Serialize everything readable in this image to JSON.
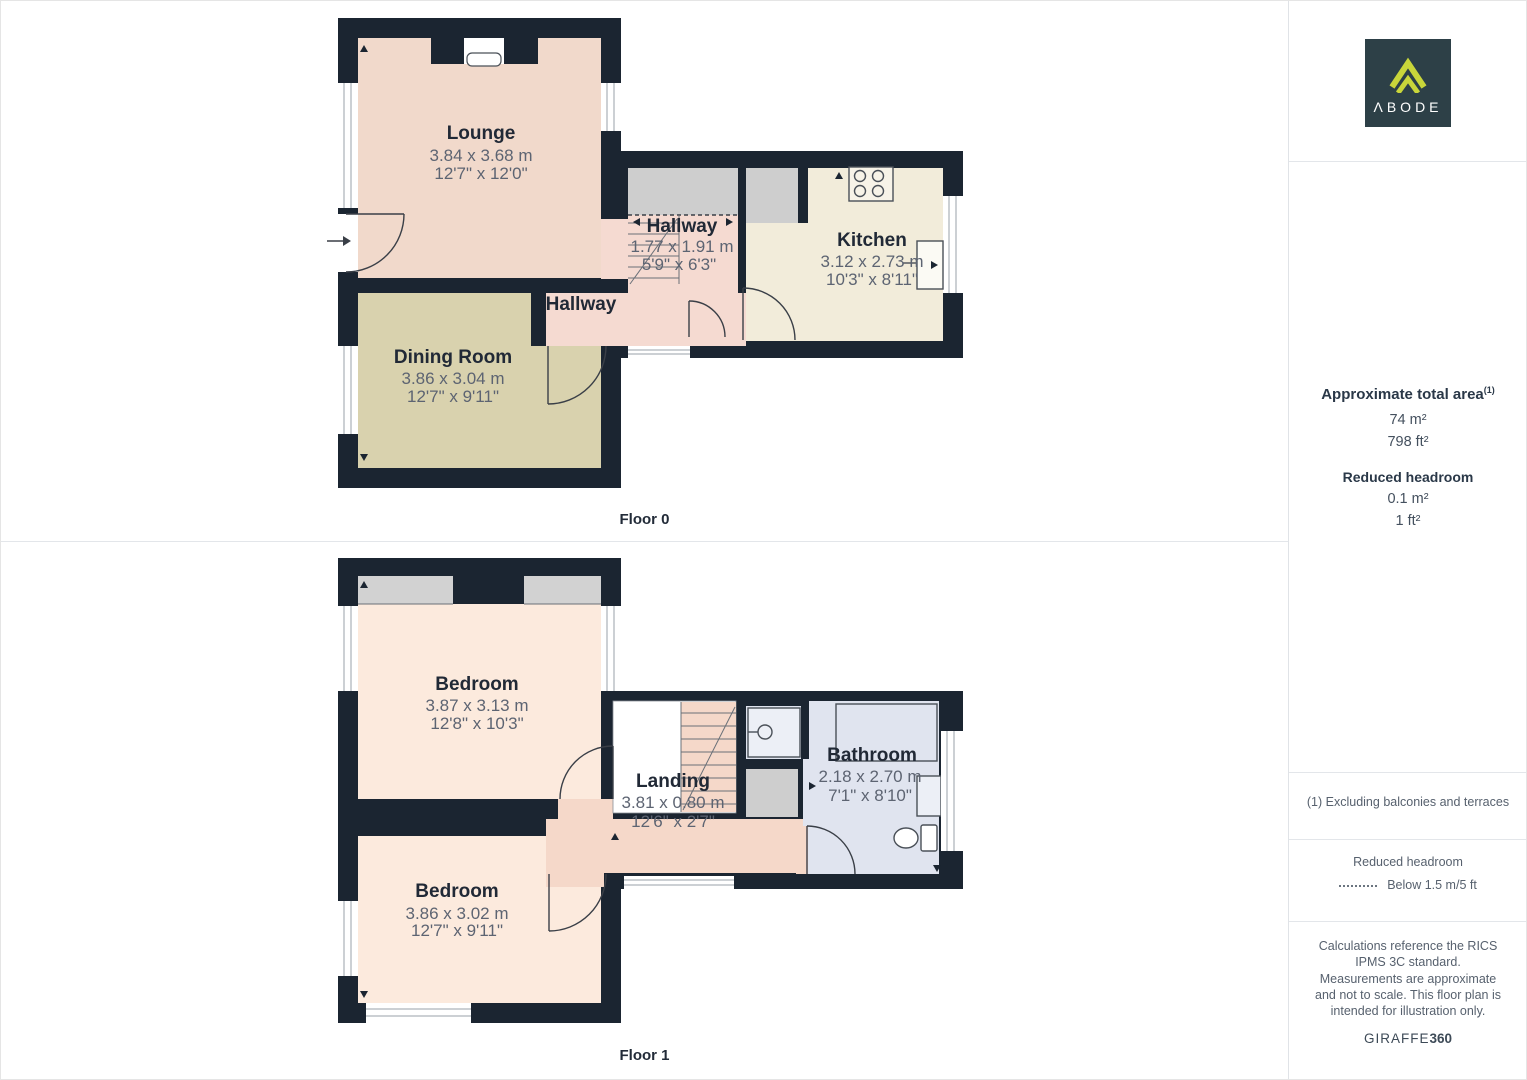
{
  "branding": {
    "logo_text": "ΛBODE",
    "logo_bg": "#2d4047",
    "logo_accent": "#c9d63a"
  },
  "sidebar": {
    "area": {
      "title": "Approximate total area",
      "superscript": "(1)",
      "metric": "74 m²",
      "imperial": "798 ft²"
    },
    "headroom": {
      "title": "Reduced headroom",
      "metric": "0.1 m²",
      "imperial": "1 ft²"
    },
    "footnote": "(1) Excluding balconies and terraces",
    "legend": {
      "title": "Reduced headroom",
      "value": "Below 1.5 m/5 ft"
    },
    "disclaimer": "Calculations reference the RICS IPMS 3C standard. Measurements are approximate and not to scale. This floor plan is intended for illustration only.",
    "brand_normal": "GIRAFFE",
    "brand_bold": "360"
  },
  "floor0": {
    "label": "Floor 0",
    "rooms": {
      "lounge": {
        "name": "Lounge",
        "dims_m": "3.84 x 3.68 m",
        "dims_ft": "12'7\" x 12'0\""
      },
      "dining": {
        "name": "Dining Room",
        "dims_m": "3.86 x 3.04 m",
        "dims_ft": "12'7\" x 9'11\""
      },
      "hallway": {
        "name": "Hallway",
        "dims_m": "1.77 x 1.91 m",
        "dims_ft": "5'9\" x 6'3\""
      },
      "hallway2": {
        "name": "Hallway"
      },
      "kitchen": {
        "name": "Kitchen",
        "dims_m": "3.12 x 2.73 m",
        "dims_ft": "10'3\" x 8'11\""
      }
    }
  },
  "floor1": {
    "label": "Floor 1",
    "rooms": {
      "bedroom1": {
        "name": "Bedroom",
        "dims_m": "3.87 x 3.13 m",
        "dims_ft": "12'8\" x 10'3\""
      },
      "bedroom2": {
        "name": "Bedroom",
        "dims_m": "3.86 x 3.02 m",
        "dims_ft": "12'7\" x 9'11\""
      },
      "landing": {
        "name": "Landing",
        "dims_m": "3.81 x 0.80 m",
        "dims_ft": "12'6\" x 2'7\""
      },
      "bathroom": {
        "name": "Bathroom",
        "dims_m": "2.18 x 2.70 m",
        "dims_ft": "7'1\" x 8'10\""
      }
    }
  },
  "colors": {
    "wall": "#1b2531",
    "lounge": "#f1d9cb",
    "dining": "#d9d2ae",
    "hallway": "#f5dad1",
    "kitchen": "#f2ecda",
    "bedroom": "#fceadd",
    "bathroom": "#e0e4ef",
    "corridor": "#f5d8c9",
    "reduced_gray": "#cecece"
  }
}
